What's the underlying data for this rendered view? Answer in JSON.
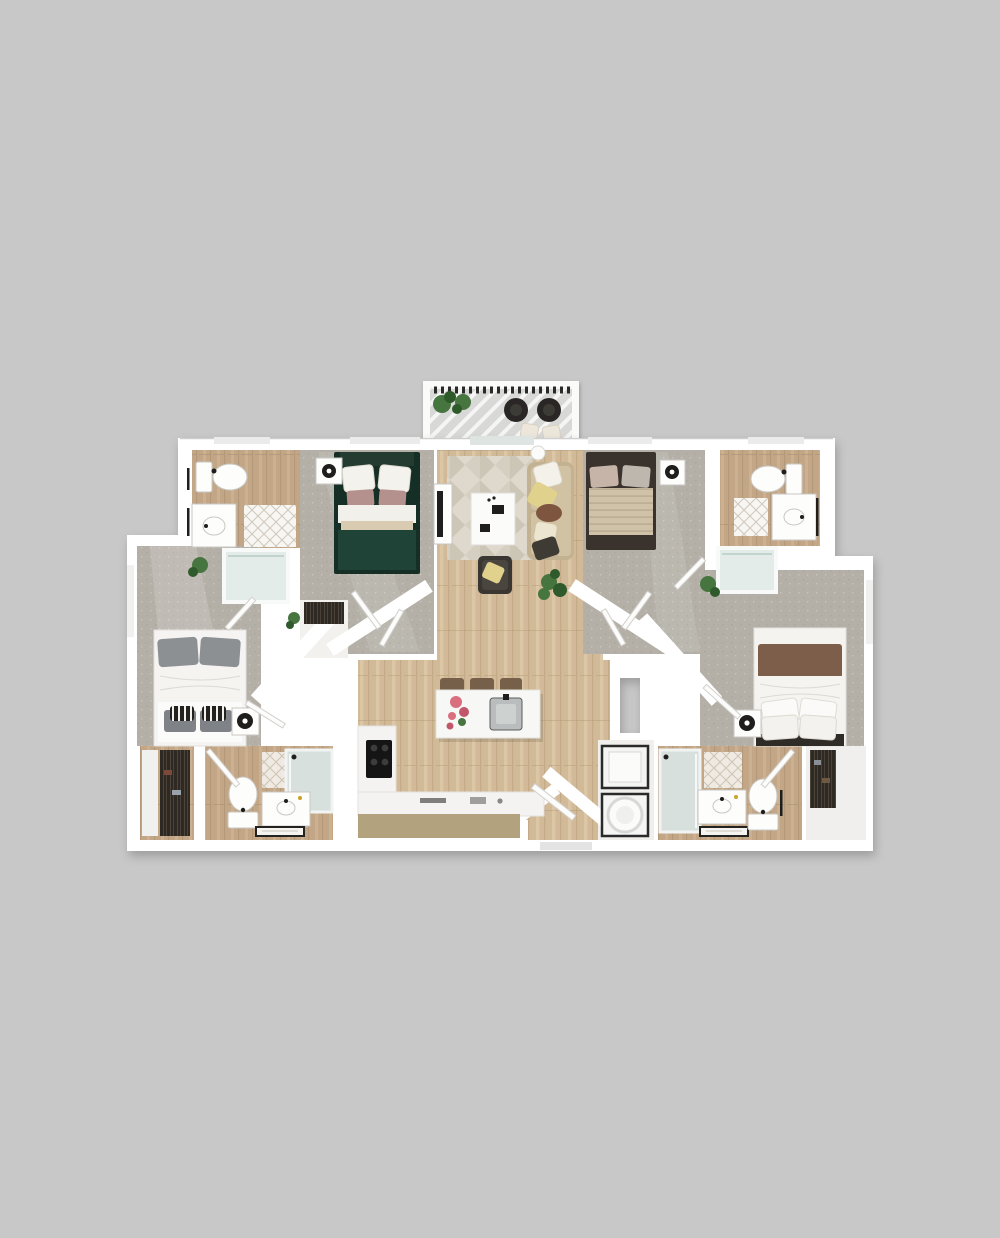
{
  "image": {
    "kind": "3d-floor-plan-render",
    "view": "top-down",
    "description": "Rendered 3D floor plan of a four-bedroom, four-bathroom apartment with central open living room and kitchen, top balcony, entry at bottom center, no text labels visible"
  },
  "colors": {
    "bg": "#c8c8c8",
    "wall": "#ffffff",
    "door": "#fcfcfb",
    "door-edge": "#d2d0cd",
    "wood": "#d2ba98",
    "wood-dark": "#b0946f",
    "wood-light": "#e2cfae",
    "woodbath": "#c2a686",
    "woodbath-dark": "#a2876a",
    "woodbath-light": "#d4bb9b",
    "carpet": "#b4b0a7",
    "carpet-dark": "#9b968c",
    "rug": "#ded9cc",
    "rug-dark": "#c3bcab",
    "deck": "#d8d8d6",
    "railing": "#2c2b29",
    "tub": "#e4ecea",
    "glass": "#d7e0dd",
    "clothes": "#2e2923",
    "green-bed": "#1f4336",
    "green-bed-dark": "#152f26",
    "mauve-pillow": "#b5918d",
    "tan-blanket": "#d0c2a9",
    "tan-bed-frame": "#3a332d",
    "gray-pillow": "#8d9093",
    "duvet": "#f5f4f1",
    "brown-blanket": "#7c5e4a",
    "sofa": "#c2b292",
    "sofa-cushion": "#d0c2a2",
    "pillow-yellow": "#e0d18c",
    "pillow-brown": "#7e5640",
    "pillow-dark": "#3e3a34",
    "armchair": "#3a3733",
    "stool": "#77604a",
    "counter-tan": "#b2a37e",
    "plant": "#46753f",
    "plant-dark": "#2f5a2c",
    "flower-pink": "#d96f7e"
  },
  "unit": {
    "rooms": [
      {
        "id": "balcony",
        "label": "balcony",
        "furniture": [
          "railing",
          "lounge-chair",
          "lounge-chair",
          "ottoman",
          "ottoman",
          "potted-plants"
        ]
      },
      {
        "id": "living-room",
        "label": "living room",
        "floor": "wood",
        "furniture": [
          "sofa",
          "coffee-table",
          "tv-console",
          "tv",
          "armchair",
          "area-rug",
          "floor-plant",
          "floor-lamp"
        ]
      },
      {
        "id": "kitchen",
        "label": "kitchen",
        "floor": "wood",
        "furniture": [
          "island",
          "island-sink",
          "bar-stool",
          "bar-stool",
          "bar-stool",
          "l-counter",
          "cooktop",
          "flower-vase"
        ]
      },
      {
        "id": "entry",
        "label": "entry",
        "floor": "wood",
        "furniture": [
          "entry-door"
        ]
      },
      {
        "id": "bedroom-top-left",
        "label": "bedroom",
        "floor": "carpet",
        "furniture": [
          "double-bed-green",
          "nightstand",
          "lamp"
        ]
      },
      {
        "id": "bedroom-top-right",
        "label": "bedroom",
        "floor": "carpet",
        "furniture": [
          "double-bed-tan",
          "nightstand",
          "lamp"
        ]
      },
      {
        "id": "bedroom-left",
        "label": "bedroom",
        "floor": "carpet",
        "furniture": [
          "double-bed-gray",
          "nightstand",
          "lamp",
          "plant"
        ]
      },
      {
        "id": "bedroom-right",
        "label": "bedroom",
        "floor": "carpet",
        "furniture": [
          "double-bed-brown",
          "nightstand",
          "lamp",
          "plant"
        ]
      },
      {
        "id": "bathroom-top-left",
        "label": "bathroom",
        "floor": "wood",
        "furniture": [
          "toilet",
          "vanity-sink",
          "bath-mat",
          "tub-shower"
        ]
      },
      {
        "id": "bathroom-top-right",
        "label": "bathroom",
        "floor": "wood",
        "furniture": [
          "toilet",
          "vanity-sink",
          "bath-mat",
          "tub-shower"
        ]
      },
      {
        "id": "bathroom-bottom-left",
        "label": "bathroom",
        "floor": "wood",
        "furniture": [
          "toilet",
          "vanity-sink",
          "bath-mat",
          "walk-in-shower",
          "door"
        ]
      },
      {
        "id": "bathroom-bottom-right",
        "label": "bathroom",
        "floor": "wood",
        "furniture": [
          "toilet",
          "vanity-sink",
          "bath-mat",
          "walk-in-shower",
          "door"
        ]
      },
      {
        "id": "closet-bottom-left",
        "label": "closet",
        "furniture": [
          "shelving",
          "hanging-clothes"
        ]
      },
      {
        "id": "closet-bottom-right",
        "label": "closet",
        "furniture": [
          "hanging-clothes"
        ]
      },
      {
        "id": "hall-closet-left",
        "label": "hall closet",
        "furniture": [
          "wardrobe"
        ]
      },
      {
        "id": "laundry-closet",
        "label": "laundry closet",
        "furniture": [
          "washer",
          "dryer"
        ]
      }
    ]
  }
}
